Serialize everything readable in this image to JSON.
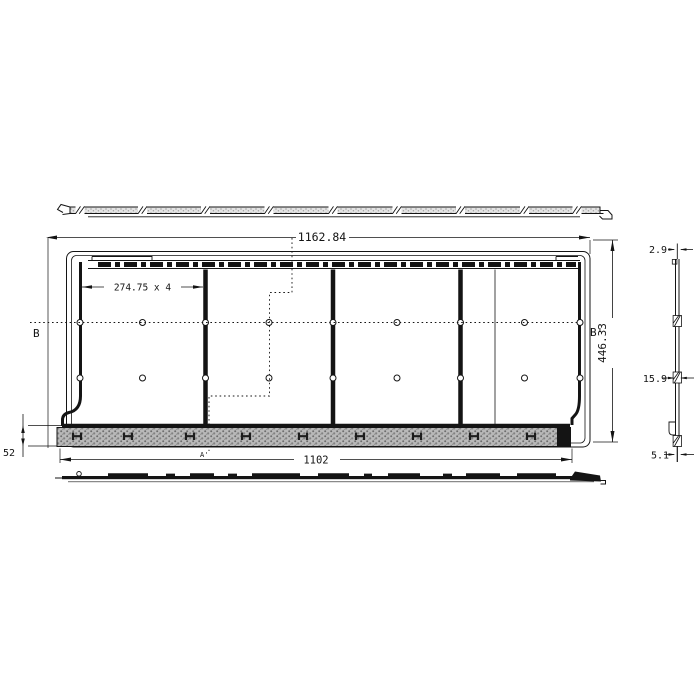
{
  "drawing": {
    "ink_color": "#141414",
    "hatch_color": "#b9b9b9",
    "labels": {
      "dim_overall_width": "1162.84",
      "dim_panel_pitch": "274.75 x 4",
      "dim_overall_height": "446.33",
      "dim_bottom_width": "1102",
      "dim_base_height": "52",
      "dim_profile_top_thickness": "2.9",
      "dim_profile_mid_thickness": "15.9",
      "dim_profile_bottom_thickness": "5.1",
      "section_left": "B",
      "section_right": "B'",
      "section_bottom": "A'"
    }
  }
}
